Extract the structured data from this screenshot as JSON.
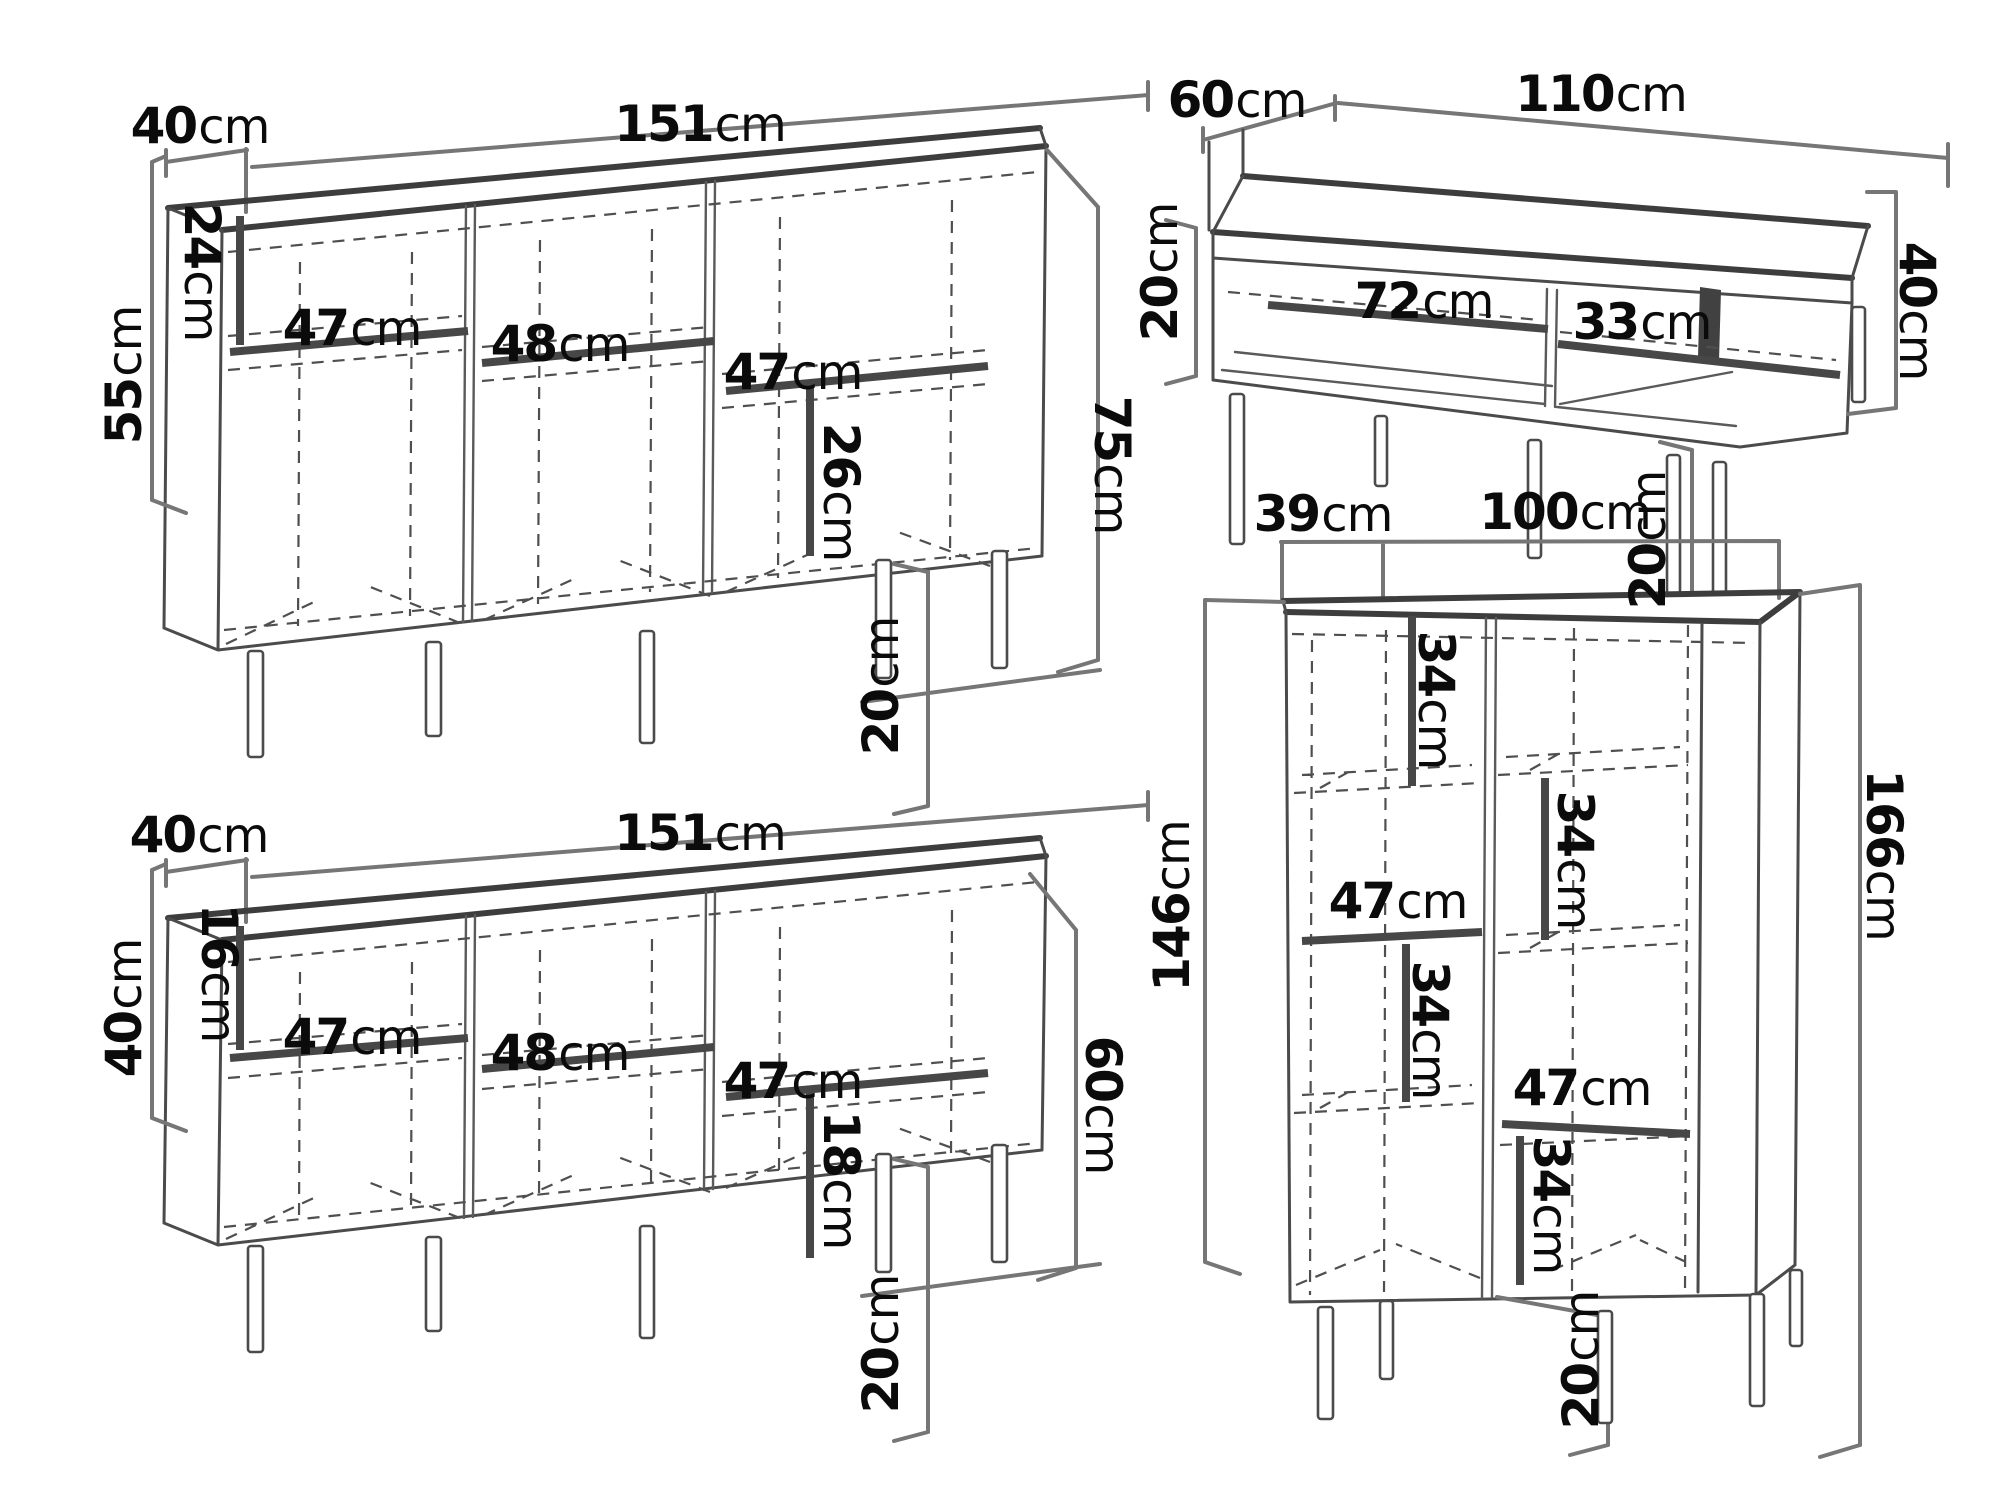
{
  "diagram": {
    "description": "Technical drawing of four furniture pieces with dimension callouts",
    "colors": {
      "background": "#ffffff",
      "line": "#4b4b4b",
      "text": "#0b0b0b",
      "bracket": "#767676"
    },
    "pieces": [
      {
        "id": "sideboard",
        "depth": {
          "v": "40",
          "u": "cm"
        },
        "width": {
          "v": "151",
          "u": "cm"
        },
        "body_height": {
          "v": "55",
          "u": "cm"
        },
        "total_height": {
          "v": "75",
          "u": "cm"
        },
        "leg_height": {
          "v": "20",
          "u": "cm"
        },
        "top_section": {
          "v": "24",
          "u": "cm"
        },
        "bay1": {
          "v": "47",
          "u": "cm"
        },
        "bay2": {
          "v": "48",
          "u": "cm"
        },
        "bay3": {
          "v": "47",
          "u": "cm"
        },
        "bottom_section": {
          "v": "26",
          "u": "cm"
        }
      },
      {
        "id": "coffee-table",
        "depth": {
          "v": "60",
          "u": "cm"
        },
        "width": {
          "v": "110",
          "u": "cm"
        },
        "shelf_height": {
          "v": "20",
          "u": "cm"
        },
        "niche_left": {
          "v": "72",
          "u": "cm"
        },
        "niche_right": {
          "v": "33",
          "u": "cm"
        },
        "total_height": {
          "v": "40",
          "u": "cm"
        },
        "leg_height": {
          "v": "20",
          "u": "cm"
        }
      },
      {
        "id": "tv-stand",
        "depth": {
          "v": "40",
          "u": "cm"
        },
        "width": {
          "v": "151",
          "u": "cm"
        },
        "body_height": {
          "v": "40",
          "u": "cm"
        },
        "total_height": {
          "v": "60",
          "u": "cm"
        },
        "leg_height": {
          "v": "20",
          "u": "cm"
        },
        "top_section": {
          "v": "16",
          "u": "cm"
        },
        "bay1": {
          "v": "47",
          "u": "cm"
        },
        "bay2": {
          "v": "48",
          "u": "cm"
        },
        "bay3": {
          "v": "47",
          "u": "cm"
        },
        "bottom_section": {
          "v": "18",
          "u": "cm"
        }
      },
      {
        "id": "highboard",
        "depth": {
          "v": "39",
          "u": "cm"
        },
        "width": {
          "v": "100",
          "u": "cm"
        },
        "body_height": {
          "v": "146",
          "u": "cm"
        },
        "total_height": {
          "v": "166",
          "u": "cm"
        },
        "leg_height": {
          "v": "20",
          "u": "cm"
        },
        "cell_a": {
          "v": "34",
          "u": "cm"
        },
        "cell_b": {
          "v": "34",
          "u": "cm"
        },
        "shelf_left": {
          "v": "47",
          "u": "cm"
        },
        "cell_c": {
          "v": "34",
          "u": "cm"
        },
        "shelf_right": {
          "v": "47",
          "u": "cm"
        },
        "cell_d": {
          "v": "34",
          "u": "cm"
        }
      }
    ]
  }
}
